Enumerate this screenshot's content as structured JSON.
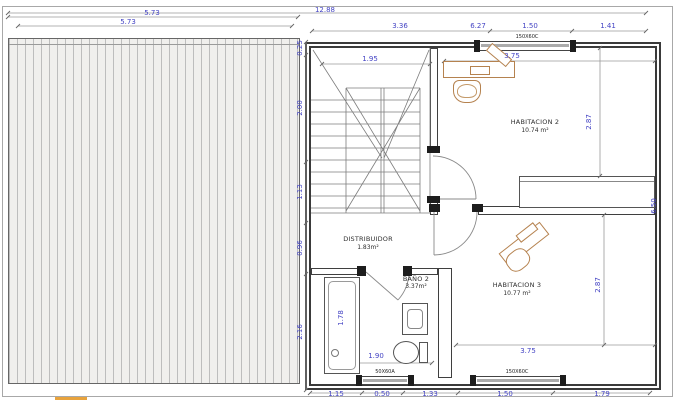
{
  "plan": {
    "rooms": [
      {
        "name": "HABITACION 2",
        "area": "10.74 m²"
      },
      {
        "name": "HABITACION 3",
        "area": "10.77 m²"
      },
      {
        "name": "DISTRIBUIDOR",
        "area": "1.83m²"
      },
      {
        "name": "BAÑO 2",
        "area": "3.37m²"
      }
    ],
    "windows": {
      "top": "150X60C",
      "bath": "50X60A",
      "bottom": "150X60C"
    },
    "dims": {
      "total_width": "12.88",
      "terrace_a": "5.73",
      "terrace_b": "5.73",
      "right_total": "6.27",
      "top_segments": [
        "3.36",
        "1.50",
        "1.41"
      ],
      "left_segments": [
        "0.25",
        "2.00",
        "1.13",
        "0.96",
        "2.16"
      ],
      "bottom_segments": [
        "1.15",
        "0.50",
        "1.33",
        "1.50",
        "1.79"
      ],
      "height_total": "6.50",
      "stair_width": "1.95",
      "hab2_width": "3.75",
      "hab2_depth": "2.87",
      "hab3_width": "3.75",
      "hab3_depth": "2.87",
      "bath_width": "1.90",
      "shower_length": "1.78"
    },
    "colors": {
      "dim_text": "#4444c4",
      "wall": "#3a3a3a",
      "furniture": "#b5824f",
      "hatch": "#bdbdbd"
    }
  }
}
